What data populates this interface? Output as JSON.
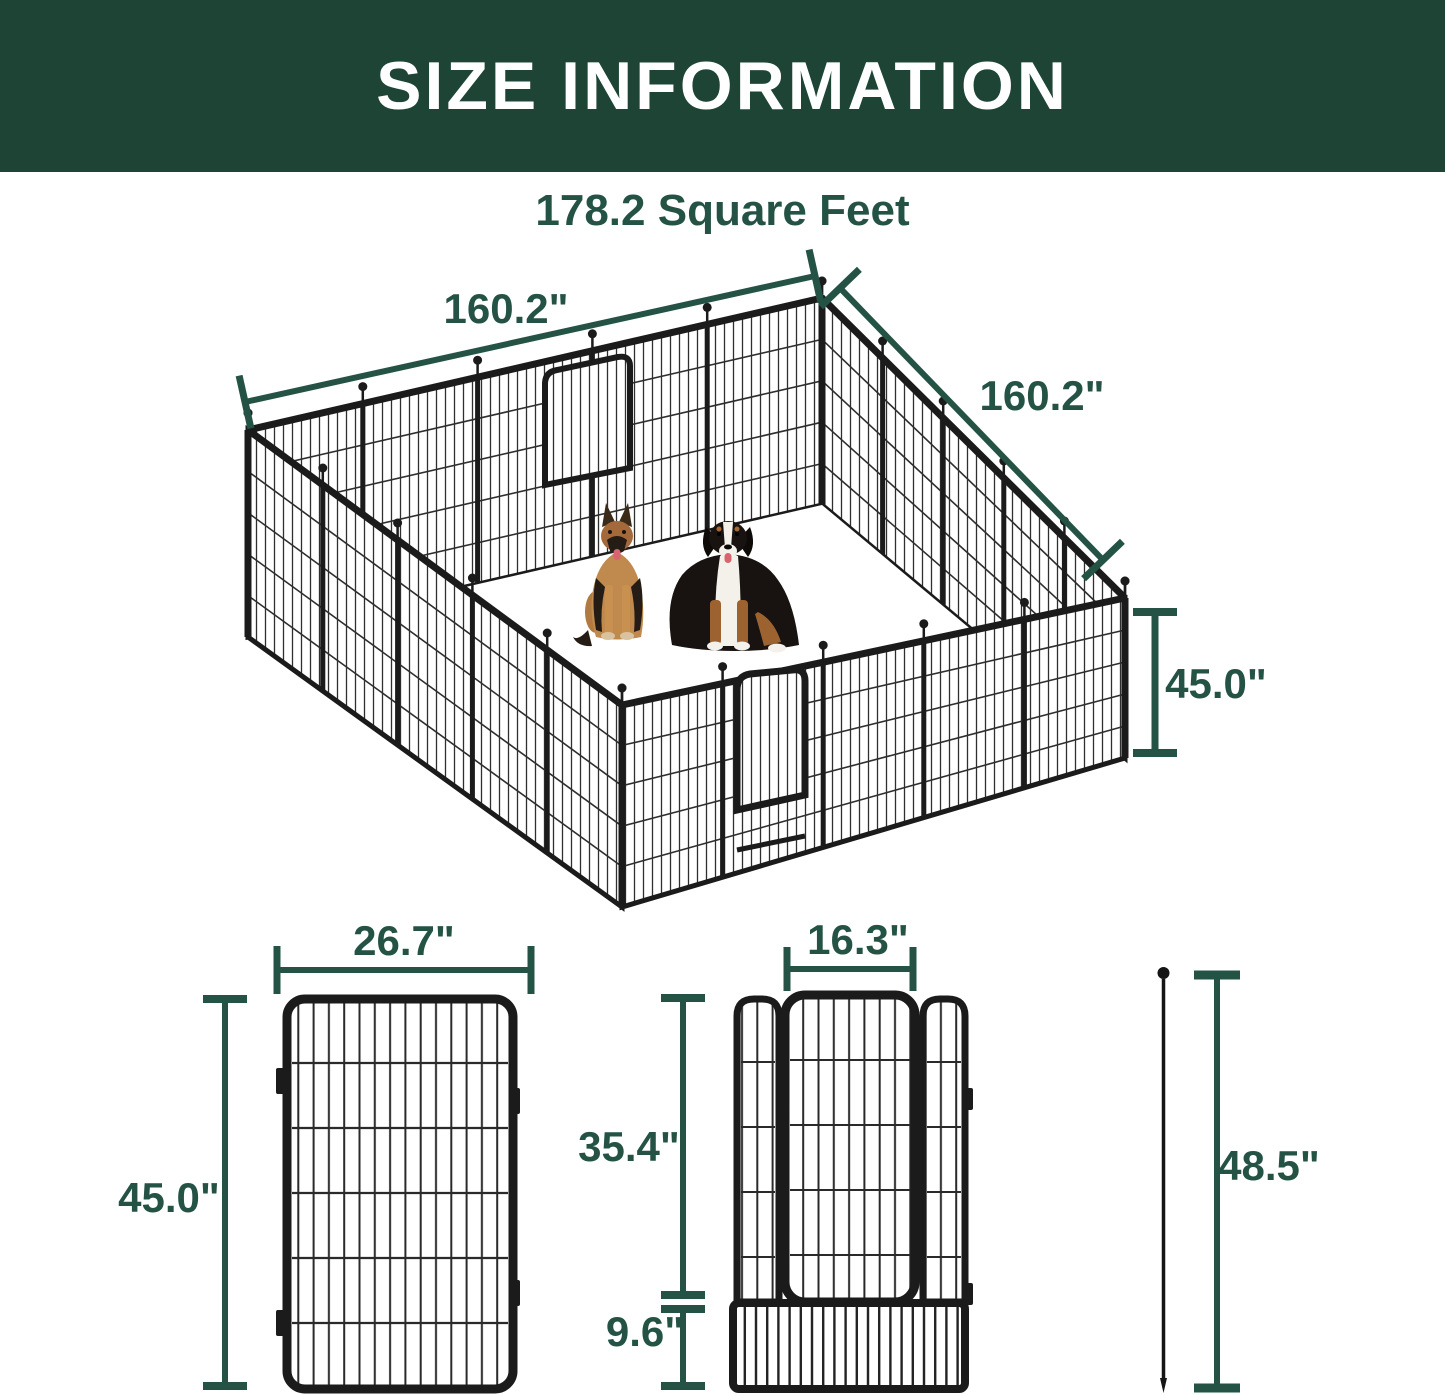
{
  "header": {
    "title": "SIZE INFORMATION"
  },
  "subtitle": "178.2 Square Feet",
  "colors": {
    "header_bg": "#1d4434",
    "accent": "#245345",
    "fence_black": "#1b1b1b"
  },
  "pen_view": {
    "width_label": "160.2\"",
    "depth_label": "160.2\"",
    "height_label": "45.0\""
  },
  "single_panel_diagram": {
    "width_label": "26.7\"",
    "height_label": "45.0\""
  },
  "gate_panel_diagram": {
    "door_width_label": "16.3\"",
    "upper_height_label": "35.4\"",
    "lower_height_label": "9.6\""
  },
  "ground_stake_diagram": {
    "height_label": "48.5\""
  }
}
